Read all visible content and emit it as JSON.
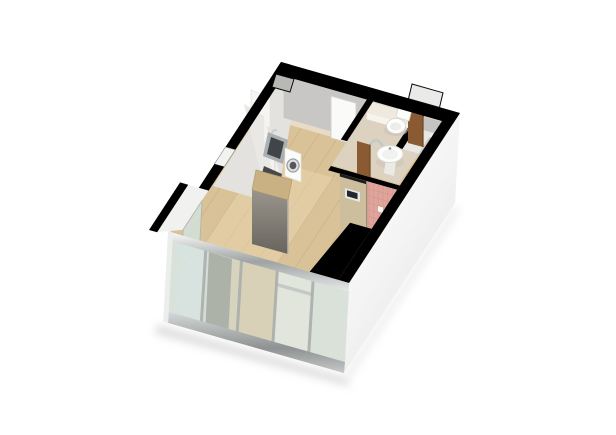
{
  "scene": {
    "type": "3d-floor-plan-render",
    "subject": "isometric dollhouse cutaway of a studio apartment with kitchen, bathroom and glass facade",
    "background": "#ffffff",
    "colors": {
      "wall_cut": "#000000",
      "floor_wood": "#d9c298",
      "floor_wood_sheen": "#ead9b4",
      "hall_floor": "#e8dcc6",
      "doormat_grey": "#d8d7d2",
      "interior_wall_grey": "#c9c7c5",
      "kitchen_back_wall": "#e3e2df",
      "door_opening_white": "#fafaf8",
      "bathroom_floor_beige": "#ddd2c0",
      "bathroom_back_wall": "#d9d2c4",
      "bathroom_ledge": "#efe9df",
      "fixture_white": "#fdfdfc",
      "tile_pink": "#dfa49b",
      "tile_pink_line": "#c98f84",
      "partition_tan": "#cdbf9e",
      "door_wood_brown": "#8a5a33",
      "counter_white": "#f3f2ef",
      "counter_top_grey": "#e9e8e5",
      "sink_steel": "#aab0b2",
      "sink_basin_dark": "#3f4549",
      "cooktop_black": "#2a2c2e",
      "washer_white": "#fbfbf9",
      "fridge_top_tan": "#c9b184",
      "glass_frost": "#d8e4df",
      "glass_clear": "#d3e2da",
      "glass_pale": "#e2ebe6",
      "backdrop_wood": "#dcc49c",
      "niche_grey": "#b8b8b6",
      "window_white": "#f2f2f0",
      "alcove_white": "#f1f1ef",
      "shadow_grey": "#c9c9c9"
    },
    "rooms": [
      "entry-hall",
      "kitchen",
      "bathroom",
      "toilet-room",
      "storage-niche",
      "main-living-area",
      "glass-facade-front"
    ],
    "fixtures": [
      "kitchen-sink",
      "cooktop",
      "washing-machine",
      "refrigerator",
      "kitchen-counter",
      "upper-cabinet",
      "toilet",
      "pedestal-sink",
      "towel-rail",
      "bathroom-door",
      "toilet-room-door",
      "intercom-panel",
      "doormat",
      "entry-door-opening",
      "window-inset",
      "corner-light-well"
    ]
  }
}
